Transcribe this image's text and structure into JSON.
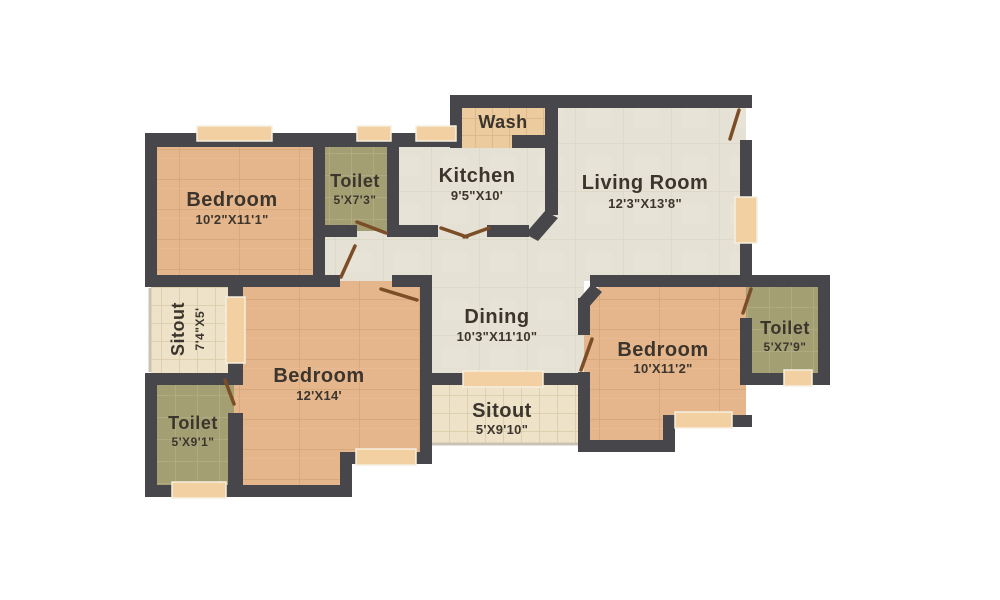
{
  "plan_title": "2 BHK style floor plan",
  "palette": {
    "wall": "#47474b",
    "door_leaf": "#7c4e27",
    "window_fill": "#f3d0a2",
    "window_border": "#f6efe0",
    "label_text": "#3b352d",
    "background": "#ffffff",
    "floor_bedroom": "#e5b58b",
    "floor_toilet": "#a49e73",
    "floor_open_plan": "#e5e1d4",
    "floor_sitout": "#eee3c9",
    "floor_wash": "#eccb9e"
  },
  "rooms": {
    "bedroom_top_left": {
      "name": "Bedroom",
      "dims": "10'2\"X11'1\""
    },
    "toilet_top": {
      "name": "Toilet",
      "dims": "5'X7'3\""
    },
    "wash": {
      "name": "Wash"
    },
    "kitchen": {
      "name": "Kitchen",
      "dims": "9'5\"X10'"
    },
    "living_room": {
      "name": "Living Room",
      "dims": "12'3\"X13'8\""
    },
    "dining": {
      "name": "Dining",
      "dims": "10'3\"X11'10\""
    },
    "sitout_left": {
      "name": "Sitout",
      "dims": "7'4\"X5'"
    },
    "bedroom_center": {
      "name": "Bedroom",
      "dims": "12'X14'"
    },
    "toilet_bottom_left": {
      "name": "Toilet",
      "dims": "5'X9'1\""
    },
    "sitout_bottom": {
      "name": "Sitout",
      "dims": "5'X9'10\""
    },
    "bedroom_right": {
      "name": "Bedroom",
      "dims": "10'X11'2\""
    },
    "toilet_right": {
      "name": "Toilet",
      "dims": "5'X7'9\""
    }
  }
}
